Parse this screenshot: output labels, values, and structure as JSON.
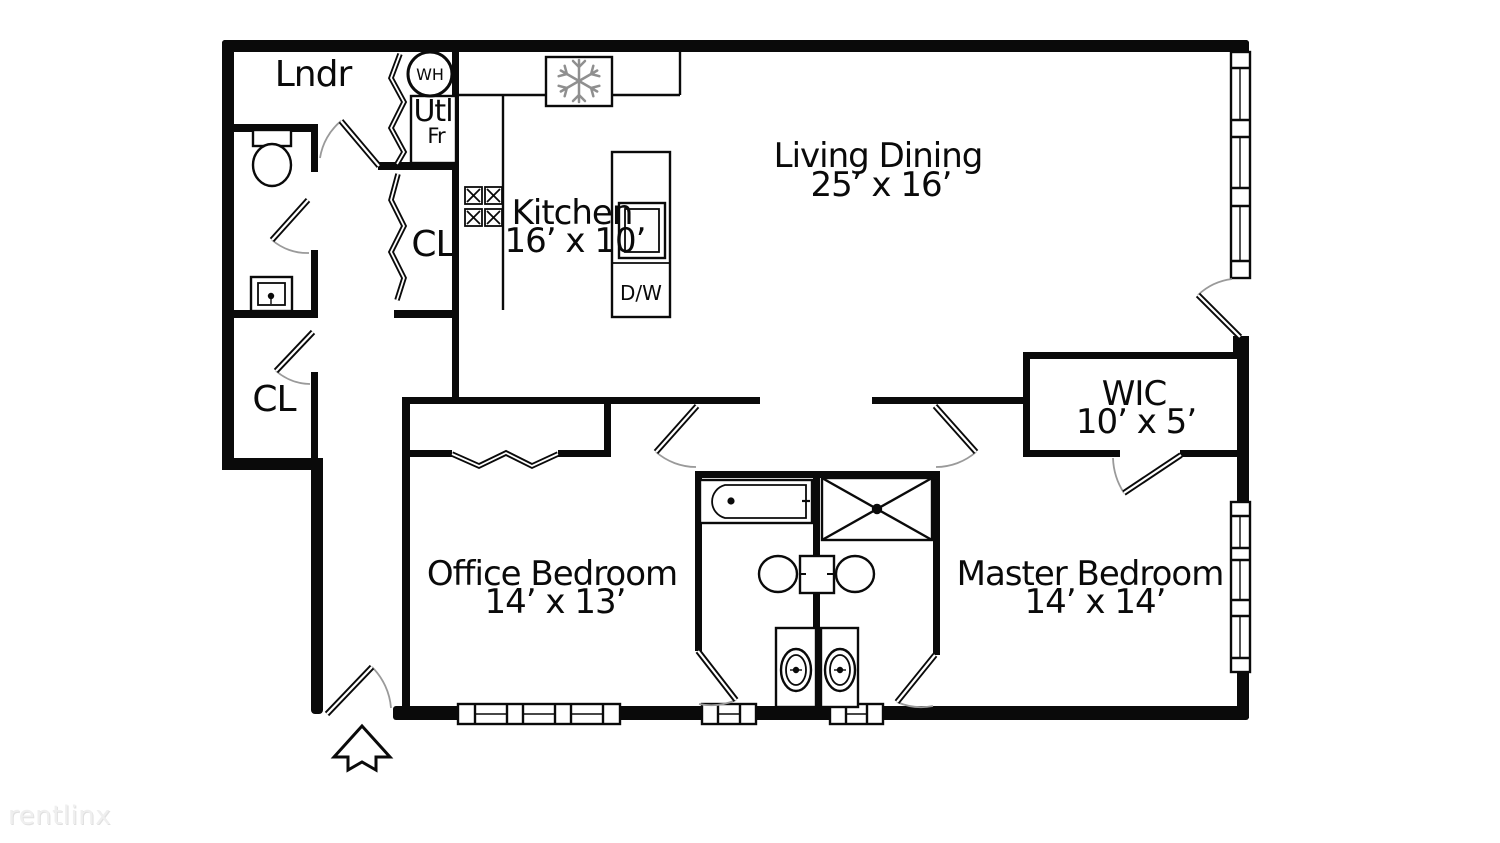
{
  "watermark": {
    "text": "rentlinx"
  },
  "labels": {
    "laundry": "Lndr",
    "water_heater": "WH",
    "utility": "Utl",
    "fridge_note": "Fr",
    "closet_upper": "CL",
    "closet_lower": "CL",
    "kitchen": "Kitchen",
    "kitchen_dim": "16’ x 10’",
    "living_dining": "Living Dining",
    "living_dining_dim": "25’ x 16’",
    "wic": "WIC",
    "wic_dim": "10’ x 5’",
    "office_bedroom": "Office Bedroom",
    "office_bedroom_dim": "14’ x 13’",
    "master_bedroom": "Master Bedroom",
    "master_bedroom_dim": "14’ x 14’",
    "dishwasher": "D/W"
  }
}
